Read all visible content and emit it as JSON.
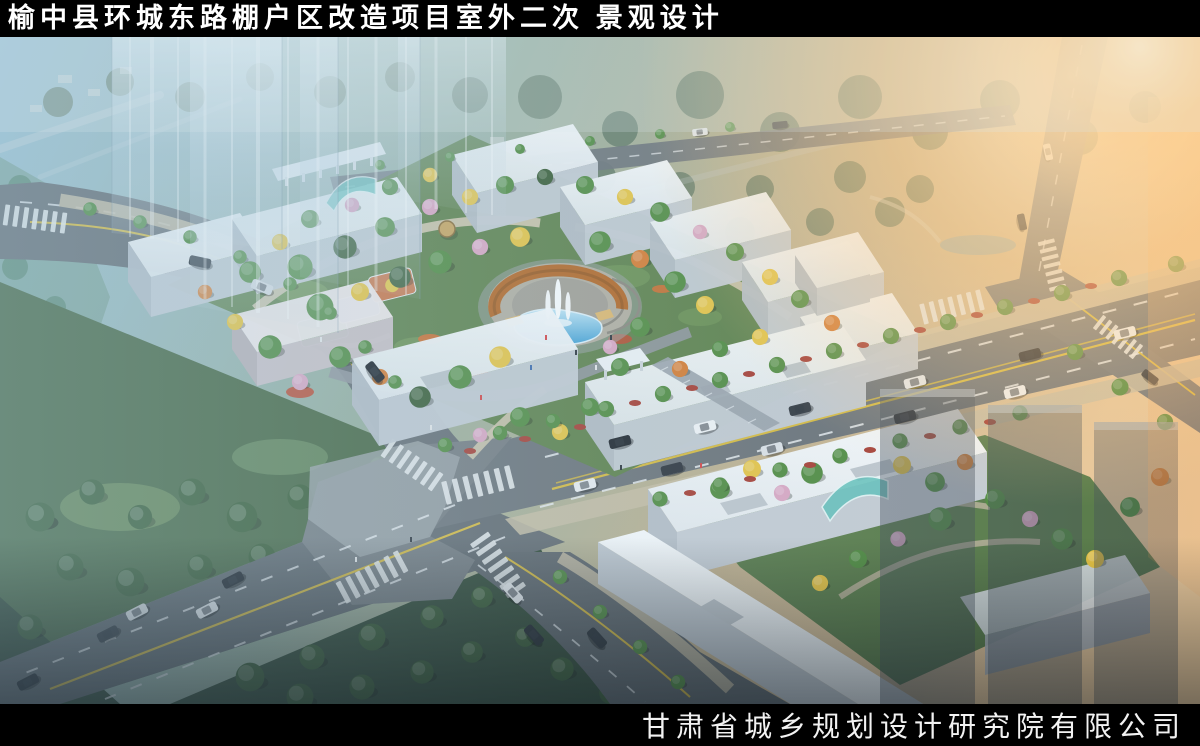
{
  "title_bar": {
    "title": "榆中县环城东路棚户区改造项目室外二次 景观设计"
  },
  "credit_bar": {
    "company": "甘肃省城乡规划设计研究院有限公司"
  },
  "scene": {
    "subject": "aerial-landscape-rendering-of-shantytown-redevelopment-block",
    "palette": {
      "sky_haze_blue": "#a9cfe3",
      "sun_glow_orange": "#f6b26b",
      "road_asphalt": "#63696e",
      "lane_yellow": "#d9ba3a",
      "lane_white": "#e9ebed",
      "building_roof_white": "#f4f7f9",
      "building_face_gray": "#c6ccd3",
      "sidewalk_tan": "#cfc3a6",
      "tree_green": "#4f8a3c",
      "tree_dark_green": "#36592f",
      "tree_yellow": "#e9c43f",
      "tree_orange": "#d97a2c",
      "blossom_pink": "#dca6c2",
      "shrub_red": "#a83a2e",
      "pool_blue": "#47a5d8",
      "pergola_orange": "#b5641f",
      "park_dark_green": "#2e4630",
      "canopy_teal": "#66c4bc"
    }
  }
}
